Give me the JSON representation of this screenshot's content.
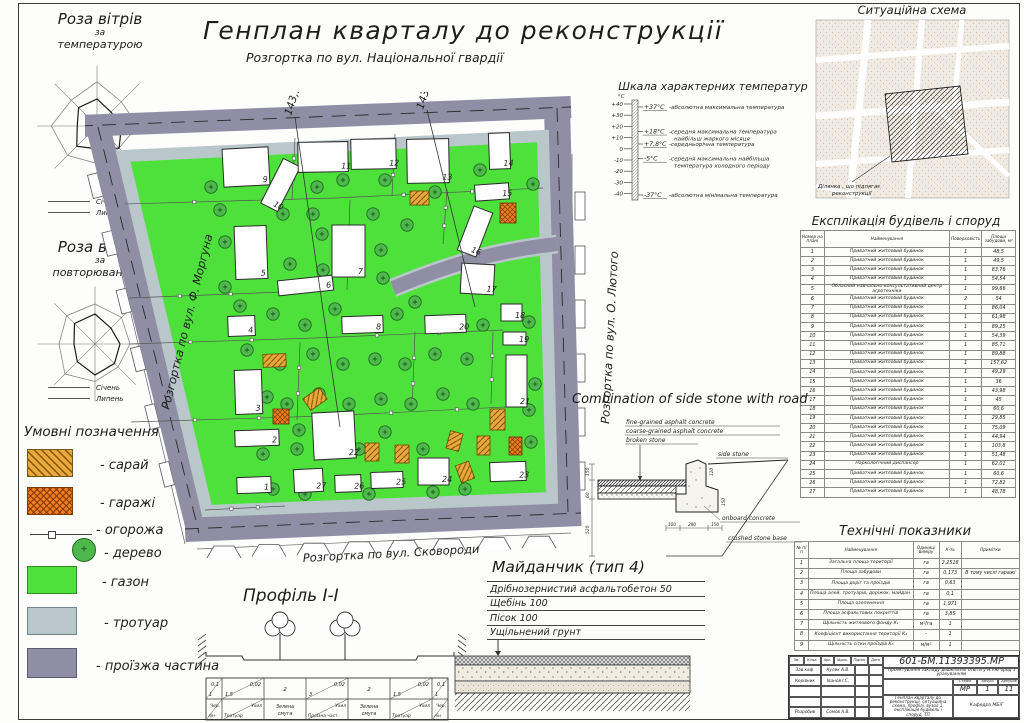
{
  "colors": {
    "lawn": "#4ee13c",
    "road": "#8f8ea4",
    "sidewalk": "#b9c6ca",
    "shed": "#e9a83b",
    "shed_hatch": "#7d5200",
    "garage": "#ef7e1f",
    "garage_hatch": "#7a3c00",
    "tree": "#4fb84d",
    "tree_edge": "#1e6b1e",
    "line": "#2e2e2e"
  },
  "header": {
    "title": "Генплан кварталу до реконструкції",
    "subtitle": "Розгортка по вул. Національної гвардії"
  },
  "wind_roses": [
    {
      "title": "Роза вітрів",
      "sub1": "за",
      "sub2": "температурою",
      "legend": [
        "Січень",
        "Липень"
      ],
      "january": [
        0.52,
        0.38,
        0.47,
        0.6,
        0.44,
        0.55,
        0.38,
        0.5
      ],
      "july": [
        0.85,
        0.66,
        0.78,
        0.6,
        0.72,
        0.8,
        0.88,
        0.7
      ]
    },
    {
      "title": "Роза вітрів",
      "sub1": "за",
      "sub2": "повторюваністю",
      "legend": [
        "Січень",
        "Липень"
      ],
      "january": [
        0.6,
        0.45,
        0.5,
        0.55,
        0.62,
        0.5,
        0.42,
        0.58
      ],
      "july": [
        0.8,
        0.75,
        0.7,
        0.65,
        0.75,
        0.85,
        0.72,
        0.8
      ]
    }
  ],
  "temperature": {
    "title": "Шкала характерних температур",
    "unit": "°C",
    "ticks": [
      "+40",
      "+30",
      "+20",
      "+10",
      "0",
      "-10",
      "-20",
      "-30",
      "-40"
    ],
    "entries": [
      {
        "v": "+37°C",
        "t": "-абсолютна максимальна температура",
        "t2": ""
      },
      {
        "v": "+18°C",
        "t": "-середня максимальна температура",
        "t2": "найбільш жаркого місяця"
      },
      {
        "v": "+7,8°C",
        "t": "-середньорічна температура",
        "t2": ""
      },
      {
        "v": "-5°C",
        "t": "-середня максимальна найбільша",
        "t2": "температура холодного періоду"
      },
      {
        "v": "-37°C",
        "t": "-абсолютна мінімальна температура",
        "t2": ""
      }
    ]
  },
  "situation": {
    "title": "Ситуаційна схема",
    "callout": [
      "Ділянка , що підлягає",
      "реконструкції"
    ]
  },
  "explication": {
    "title": "Експлікація будівель і споруд",
    "headers": [
      "Номер на плані",
      "Найменування",
      "Поверховість",
      "Площа забудови, м²"
    ],
    "rows": [
      [
        "1",
        "Приватний житловий будинок",
        "1",
        "48,5"
      ],
      [
        "2",
        "Приватний житловий будинок",
        "1",
        "49,5"
      ],
      [
        "3",
        "Приватний житловий будинок",
        "1",
        "83,76"
      ],
      [
        "4",
        "Приватний житловий будинок",
        "1",
        "54,54"
      ],
      [
        "5",
        "Обласний навчально-консультативний центр агротехніки",
        "1",
        "99,66"
      ],
      [
        "6",
        "Приватний житловий будинок",
        "2",
        "54"
      ],
      [
        "7",
        "Приватний житловий будинок",
        "1",
        "86,04"
      ],
      [
        "8",
        "Приватний житловий будинок",
        "1",
        "61,98"
      ],
      [
        "9",
        "Приватний житловий будинок",
        "1",
        "89,25"
      ],
      [
        "10",
        "Приватний житловий будинок",
        "1",
        "54,39"
      ],
      [
        "11",
        "Приватний житловий будинок",
        "1",
        "85,71"
      ],
      [
        "12",
        "Приватний житловий будинок",
        "1",
        "89,88"
      ],
      [
        "13",
        "Приватний житловий будинок",
        "1",
        "157,62"
      ],
      [
        "14",
        "Приватний житловий будинок",
        "1",
        "49,29"
      ],
      [
        "15",
        "Приватний житловий будинок",
        "1",
        "36"
      ],
      [
        "16",
        "Приватний житловий будинок",
        "1",
        "43,98"
      ],
      [
        "17",
        "Приватний житловий будинок",
        "1",
        "45"
      ],
      [
        "18",
        "Приватний житловий будинок",
        "1",
        "60,6"
      ],
      [
        "19",
        "Приватний житловий будинок",
        "1",
        "29,85"
      ],
      [
        "20",
        "Приватний житловий будинок",
        "1",
        "75,09"
      ],
      [
        "21",
        "Приватний житловий будинок",
        "1",
        "44,94"
      ],
      [
        "22",
        "Приватний житловий будинок",
        "1",
        "103,8"
      ],
      [
        "23",
        "Приватний житловий будинок",
        "1",
        "51,48"
      ],
      [
        "24",
        "Наркологічний диспансер",
        "1",
        "62,01"
      ],
      [
        "25",
        "Приватний житловий будинок",
        "1",
        "60,6"
      ],
      [
        "26",
        "Приватний житловий будинок",
        "1",
        "72,82"
      ],
      [
        "27",
        "Приватний житловий будинок",
        "1",
        "48,78"
      ]
    ]
  },
  "side_stone": {
    "title": "Combination of side stone with road",
    "layers": [
      "fine-grained asphalt concrete",
      "coarse-grained asphalt concrete",
      "broken stone"
    ],
    "labels": {
      "side_stone": "side stone",
      "onboard": "onboard concrete",
      "crushed": "crushed stone base"
    },
    "dims": {
      "left": [
        "150",
        "60",
        "520"
      ],
      "bottom": [
        "100",
        "280",
        "150"
      ],
      "right": [
        "120",
        "150"
      ]
    }
  },
  "tech": {
    "title": "Технічні показники",
    "headers": [
      "№ п/п",
      "Найменування",
      "Одиниці виміру",
      "К-ть",
      "Примітки"
    ],
    "rows": [
      [
        "1",
        "Загальна площа території",
        "га",
        "2,2518",
        ""
      ],
      [
        "2",
        "Площа забудови",
        "га",
        "0,173",
        "В тому числі гаражі"
      ],
      [
        "3",
        "Площа доріг та проїздів",
        "га",
        "0,63",
        ""
      ],
      [
        "4",
        "Площа алей, тротуарів, доріжок, майдан.",
        "га",
        "0,1",
        ""
      ],
      [
        "5",
        "Площа озеленення",
        "га",
        "1,971",
        ""
      ],
      [
        "6",
        "Площа асфальтових покриттів",
        "га",
        "3,85",
        ""
      ],
      [
        "7",
        "Щільність житлового фонду К₁",
        "м²/га",
        "1",
        ""
      ],
      [
        "8",
        "Коефіцієнт використання території К₂",
        "–",
        "1",
        ""
      ],
      [
        "9",
        "Щільність сітки проїздів К₃",
        "м/м²",
        "1",
        ""
      ]
    ]
  },
  "title_block": {
    "doc": "601-БМ.11393395.МР",
    "project": "Проектування закладу дошкільної освіти у м.Ужгород з урахуванням",
    "sig_headers": [
      "Зм.",
      "Кільк.",
      "Арк.",
      "№док.",
      "Підпис",
      "Дата"
    ],
    "sig_rows": [
      [
        "Зав.каф.",
        "Кулик А.В."
      ],
      [
        "Керівник",
        "Іванов І.С."
      ],
      [
        "",
        ""
      ],
      [
        "",
        ""
      ],
      [
        "Розробив",
        "Сомов А.В."
      ]
    ],
    "stage_headers": [
      "Стадія",
      "Аркуш",
      "Аркушів"
    ],
    "stage": "МР",
    "sheet": "1",
    "sheets": "11",
    "content": "Генплан кварталу до реконструкції, ситуаційна схема, профілі, вузол 1, експлікація будівель і споруд, ТП",
    "dept": "Кафедра МБіГ"
  },
  "legend": {
    "title": "Умовні позначення",
    "items": [
      {
        "label": "- сарай",
        "type": "shed"
      },
      {
        "label": "- гаражі",
        "type": "garage"
      },
      {
        "label": "- огорожа",
        "type": "fence"
      },
      {
        "label": "- дерево",
        "type": "tree"
      },
      {
        "label": "- газон",
        "type": "lawn"
      },
      {
        "label": "- тротуар",
        "type": "sidewalk"
      },
      {
        "label": "- проїзжа частина",
        "type": "road"
      }
    ]
  },
  "profile": {
    "title": "Профіль І-І",
    "cells_top": [
      [
        "0,1",
        "1"
      ],
      [
        "0,02",
        "1,5"
      ],
      [
        "2",
        ""
      ],
      [
        "0,02",
        "3"
      ],
      [
        "2",
        ""
      ],
      [
        "0,02",
        "1,5"
      ],
      [
        "0,1",
        "1"
      ]
    ],
    "cells_bottom": [
      [
        "Чер.",
        "лін"
      ],
      [
        "Ухил",
        "Тротуар"
      ],
      [
        "Зелена",
        "смуга"
      ],
      [
        "Ухил",
        "Проїзна част."
      ],
      [
        "Зелена",
        "смуга"
      ],
      [
        "Ухил",
        "Тротуар"
      ],
      [
        "Чер.",
        "лін"
      ]
    ]
  },
  "playground": {
    "title": "Майданчик (тип 4)",
    "layers": [
      "Дрібнозернистий асфальтобетон 50",
      "Щебінь 100",
      "Пісок 100",
      "Ущільнений грунт"
    ]
  },
  "plan": {
    "streets": {
      "left": "Розгортка по вул. Ф. Моргуна",
      "right": "Розгортка по вул. О. Лютого",
      "bottom": "Розгортка по вул. Сковороди"
    },
    "marks": [
      "143,5",
      "143,0"
    ],
    "buildings": [
      {
        "n": "1",
        "x": 152,
        "y": 385,
        "w": 34,
        "h": 16,
        "r": -2
      },
      {
        "n": "2",
        "x": 150,
        "y": 338,
        "w": 44,
        "h": 16,
        "r": -2
      },
      {
        "n": "3",
        "x": 150,
        "y": 278,
        "w": 27,
        "h": 44,
        "r": -2
      },
      {
        "n": "4",
        "x": 143,
        "y": 224,
        "w": 27,
        "h": 20,
        "r": -2
      },
      {
        "n": "5",
        "x": 150,
        "y": 134,
        "w": 32,
        "h": 53,
        "r": -2
      },
      {
        "n": "6",
        "x": 193,
        "y": 186,
        "w": 55,
        "h": 15,
        "r": -6
      },
      {
        "n": "7",
        "x": 247,
        "y": 133,
        "w": 33,
        "h": 52,
        "r": 0
      },
      {
        "n": "8",
        "x": 257,
        "y": 224,
        "w": 41,
        "h": 17,
        "r": -2
      },
      {
        "n": "9",
        "x": 138,
        "y": 56,
        "w": 46,
        "h": 38,
        "r": -3
      },
      {
        "n": "10",
        "x": 186,
        "y": 68,
        "w": 19,
        "h": 50,
        "r": 27
      },
      {
        "n": "11",
        "x": 213,
        "y": 50,
        "w": 50,
        "h": 30,
        "r": -1
      },
      {
        "n": "12",
        "x": 266,
        "y": 47,
        "w": 45,
        "h": 30,
        "r": -1
      },
      {
        "n": "13",
        "x": 322,
        "y": 47,
        "w": 42,
        "h": 44,
        "r": -1
      },
      {
        "n": "14",
        "x": 404,
        "y": 41,
        "w": 21,
        "h": 36,
        "r": -2
      },
      {
        "n": "15",
        "x": 390,
        "y": 92,
        "w": 34,
        "h": 16,
        "r": -4
      },
      {
        "n": "16",
        "x": 380,
        "y": 116,
        "w": 20,
        "h": 47,
        "r": 21
      },
      {
        "n": "17",
        "x": 376,
        "y": 172,
        "w": 33,
        "h": 30,
        "r": 3
      },
      {
        "n": "18",
        "x": 416,
        "y": 212,
        "w": 21,
        "h": 17,
        "r": 0
      },
      {
        "n": "19",
        "x": 418,
        "y": 240,
        "w": 23,
        "h": 13,
        "r": 0
      },
      {
        "n": "20",
        "x": 340,
        "y": 223,
        "w": 41,
        "h": 18,
        "r": -2
      },
      {
        "n": "21",
        "x": 421,
        "y": 263,
        "w": 21,
        "h": 52,
        "r": 0
      },
      {
        "n": "22",
        "x": 228,
        "y": 320,
        "w": 42,
        "h": 47,
        "r": -3
      },
      {
        "n": "23",
        "x": 405,
        "y": 370,
        "w": 36,
        "h": 19,
        "r": -2
      },
      {
        "n": "24",
        "x": 333,
        "y": 366,
        "w": 31,
        "h": 27,
        "r": 0
      },
      {
        "n": "25",
        "x": 286,
        "y": 380,
        "w": 32,
        "h": 16,
        "r": -2
      },
      {
        "n": "26",
        "x": 250,
        "y": 383,
        "w": 26,
        "h": 17,
        "r": -2
      },
      {
        "n": "27",
        "x": 209,
        "y": 377,
        "w": 29,
        "h": 23,
        "r": -3
      }
    ],
    "sheds": [
      [
        325,
        99,
        19,
        14,
        0
      ],
      [
        178,
        262,
        23,
        13,
        -2
      ],
      [
        220,
        300,
        20,
        14,
        -35
      ],
      [
        280,
        351,
        14,
        18,
        0
      ],
      [
        310,
        353,
        14,
        18,
        0
      ],
      [
        363,
        340,
        13,
        18,
        15
      ],
      [
        373,
        371,
        14,
        18,
        -20
      ],
      [
        392,
        344,
        13,
        19,
        0
      ],
      [
        405,
        317,
        15,
        21,
        0
      ]
    ],
    "garages": [
      [
        415,
        111,
        16,
        20,
        0
      ],
      [
        188,
        317,
        16,
        15,
        0
      ],
      [
        424,
        345,
        13,
        18,
        0
      ]
    ],
    "trees": [
      [
        126,
        95
      ],
      [
        232,
        95
      ],
      [
        258,
        88
      ],
      [
        300,
        88
      ],
      [
        350,
        100
      ],
      [
        395,
        78
      ],
      [
        448,
        92
      ],
      [
        135,
        118
      ],
      [
        140,
        150
      ],
      [
        198,
        122
      ],
      [
        228,
        122
      ],
      [
        237,
        142
      ],
      [
        288,
        122
      ],
      [
        322,
        133
      ],
      [
        140,
        195
      ],
      [
        205,
        172
      ],
      [
        238,
        178
      ],
      [
        296,
        158
      ],
      [
        298,
        186
      ],
      [
        155,
        214
      ],
      [
        188,
        222
      ],
      [
        220,
        233
      ],
      [
        250,
        217
      ],
      [
        282,
        233
      ],
      [
        312,
        222
      ],
      [
        330,
        210
      ],
      [
        398,
        233
      ],
      [
        444,
        230
      ],
      [
        162,
        258
      ],
      [
        195,
        272
      ],
      [
        228,
        262
      ],
      [
        258,
        272
      ],
      [
        290,
        267
      ],
      [
        320,
        272
      ],
      [
        350,
        262
      ],
      [
        382,
        267
      ],
      [
        450,
        292
      ],
      [
        182,
        305
      ],
      [
        202,
        312
      ],
      [
        234,
        302
      ],
      [
        264,
        312
      ],
      [
        296,
        307
      ],
      [
        326,
        312
      ],
      [
        358,
        302
      ],
      [
        388,
        312
      ],
      [
        444,
        318
      ],
      [
        178,
        362
      ],
      [
        212,
        357
      ],
      [
        214,
        338
      ],
      [
        274,
        357
      ],
      [
        300,
        340
      ],
      [
        338,
        357
      ],
      [
        446,
        350
      ],
      [
        188,
        397
      ],
      [
        220,
        402
      ],
      [
        284,
        402
      ],
      [
        348,
        400
      ],
      [
        380,
        397
      ]
    ],
    "fences": [
      [
        40,
        112,
        250,
        106
      ],
      [
        250,
        106,
        458,
        96
      ],
      [
        44,
        206,
        198,
        200
      ],
      [
        44,
        252,
        230,
        246
      ],
      [
        230,
        246,
        418,
        238
      ],
      [
        46,
        330,
        240,
        324
      ],
      [
        240,
        324,
        440,
        314
      ],
      [
        265,
        108,
        262,
        198
      ],
      [
        362,
        98,
        358,
        152
      ],
      [
        215,
        250,
        212,
        328
      ],
      [
        330,
        240,
        327,
        318
      ],
      [
        408,
        240,
        406,
        312
      ],
      [
        210,
        46,
        207,
        108
      ],
      [
        310,
        42,
        307,
        104
      ],
      [
        120,
        418,
        200,
        414
      ]
    ]
  }
}
